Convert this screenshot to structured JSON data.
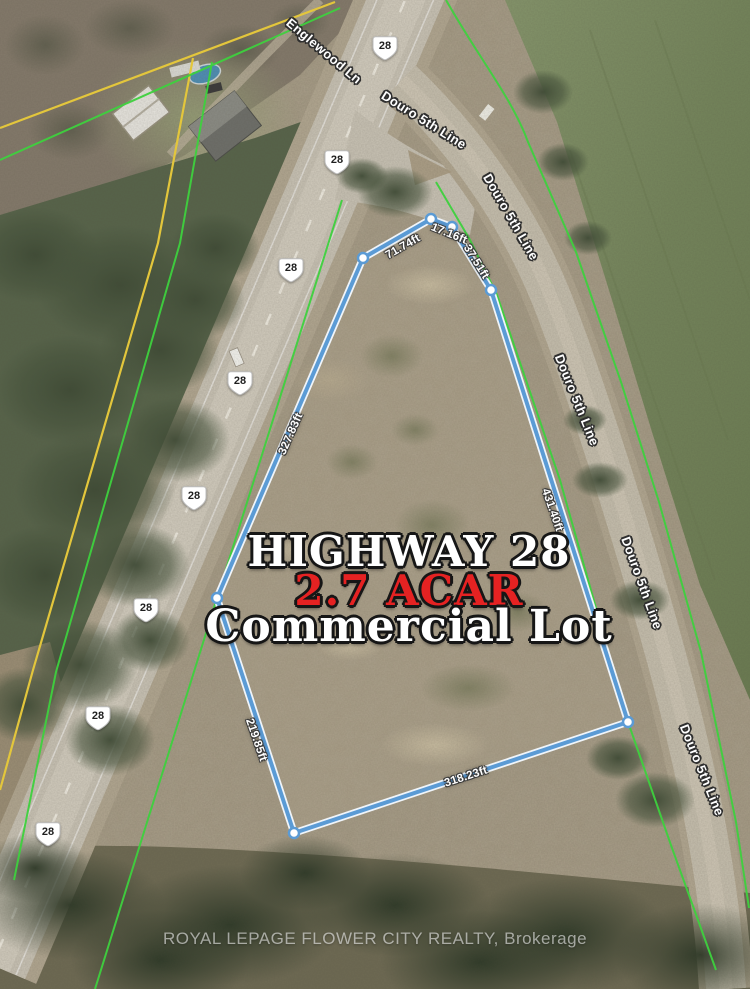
{
  "listing_map": {
    "title": {
      "highway": "HIGHWAY 28",
      "acreage": "2.7 ACAR",
      "lot_type": "Commercial Lot"
    },
    "watermark": "ROYAL LEPAGE FLOWER CITY REALTY, Brokerage",
    "highway_shields": [
      "28",
      "28",
      "28",
      "28",
      "28",
      "28",
      "28",
      "28"
    ],
    "road_labels": [
      "Englewood Ln",
      "Douro 5th Line",
      "Douro 5th Line",
      "Douro 5th Line",
      "Douro 5th Line",
      "Douro 5th Line"
    ],
    "lot_dimensions": {
      "side_nw": "71.74ft",
      "side_n": "17.16ft",
      "side_ne": "37.51ft",
      "side_w": "327.83ft",
      "side_e": "431.40ft",
      "side_sw": "219.85ft",
      "side_s": "318.23ft"
    },
    "colors": {
      "boundary_blue": "#5b9bd5",
      "parcel_line_green": "#3ed13e",
      "property_line_yellow": "#e3c63c",
      "acreage_red": "#e52222",
      "field_green": "#74855b"
    }
  }
}
